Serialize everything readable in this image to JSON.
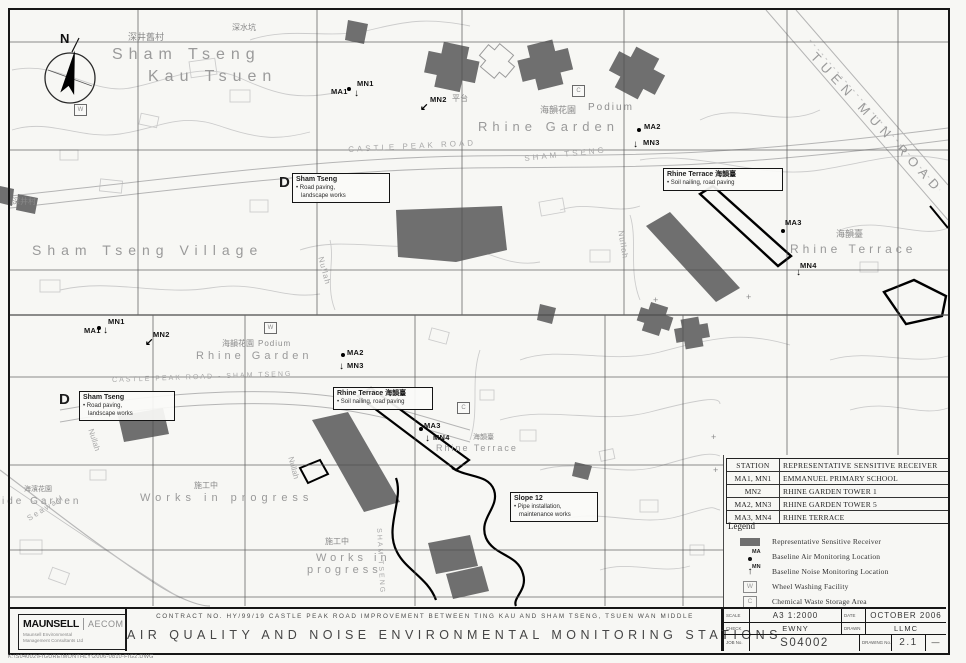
{
  "sheet": {
    "contract_line": "CONTRACT NO. HY/99/19 CASTLE PEAK ROAD IMPROVEMENT BETWEEN TING KAU AND SHAM TSENG, TSUEN WAN MIDDLE",
    "title": "AIR QUALITY AND NOISE ENVIRONMENTAL MONITORING STATIONS",
    "file_path": "K:\\S04002\\FIGURE\\MONTHLY\\2006-0810-FIG2.DWG"
  },
  "logo": {
    "name1": "MAUNSELL",
    "name2": "AECOM",
    "sub1": "Maunsell Environmental",
    "sub2": "Management Consultants Ltd"
  },
  "title_block": {
    "scale_label": "SCALE",
    "scale_value": "A3 1:2000",
    "date_label": "DATE",
    "date_value": "OCTOBER 2006",
    "check_label": "CHECK",
    "check_value": "EWNY",
    "drawn_label": "DRAWN",
    "drawn_value": "LLMC",
    "job_label": "JOB No.",
    "job_value": "S04002",
    "drawing_label": "DRAWING No.",
    "drawing_value": "2.1",
    "rev_label": "REV",
    "rev_value": "—"
  },
  "receiver_table": {
    "headers": [
      "STATION",
      "REPRESENTATIVE SENSITIVE RECEIVER"
    ],
    "rows": [
      [
        "MA1, MN1",
        "EMMANUEL PRIMARY SCHOOL"
      ],
      [
        "MN2",
        "RHINE GARDEN TOWER 1"
      ],
      [
        "MA2, MN3",
        "RHINE GARDEN TOWER 5"
      ],
      [
        "MA3, MN4",
        "RHINE TERRACE"
      ]
    ]
  },
  "legend": {
    "title": "Legend",
    "items": [
      {
        "symbol": "receiver",
        "tag": "",
        "label": "Representative Sensitive Receiver"
      },
      {
        "symbol": "air",
        "tag": "MA",
        "label": "Baseline Air Monitoring Location"
      },
      {
        "symbol": "noise",
        "tag": "MN",
        "label": "Baseline Noise Monitoring Location"
      },
      {
        "symbol": "wheel",
        "tag": "W",
        "label": "Wheel Washing Facility"
      },
      {
        "symbol": "chemical",
        "tag": "C",
        "label": "Chemical Waste Storage Area"
      }
    ]
  },
  "maps": {
    "top": {
      "labels": [
        {
          "text": "N",
          "x": 60,
          "y": 32,
          "s": 13,
          "cls": "nmark"
        },
        {
          "text": "深井舊村",
          "x": 128,
          "y": 33,
          "s": 9,
          "cls": "cn"
        },
        {
          "text": "Sham Tseng",
          "x": 112,
          "y": 47,
          "s": 16,
          "ls": 6,
          "cls": "big"
        },
        {
          "text": "Kau Tsuen",
          "x": 148,
          "y": 69,
          "s": 16,
          "ls": 6,
          "cls": "big"
        },
        {
          "text": "深水坑",
          "x": 232,
          "y": 24,
          "s": 8,
          "cls": "cn"
        },
        {
          "text": "平台",
          "x": 452,
          "y": 95,
          "s": 8,
          "cls": "cn"
        },
        {
          "text": "海韻花園",
          "x": 540,
          "y": 106,
          "s": 9,
          "cls": "cn"
        },
        {
          "text": "Podium",
          "x": 588,
          "y": 103,
          "s": 10,
          "ls": 2,
          "cls": "mid"
        },
        {
          "text": "Rhine Garden",
          "x": 478,
          "y": 120,
          "s": 13,
          "ls": 5,
          "cls": "big"
        },
        {
          "text": "CASTLE PEAK ROAD",
          "x": 348,
          "y": 146,
          "s": 8,
          "ls": 3,
          "rot": -3,
          "cls": "road"
        },
        {
          "text": "SHAM TSENG",
          "x": 524,
          "y": 155,
          "s": 8,
          "ls": 3,
          "rot": -6,
          "cls": "road"
        },
        {
          "text": "TUEN MUN ROAD",
          "x": 818,
          "y": 50,
          "s": 13,
          "ls": 6,
          "rot": 47,
          "cls": "big"
        },
        {
          "text": "Sham Tseng Village",
          "x": 32,
          "y": 243,
          "s": 14,
          "ls": 6,
          "cls": "big"
        },
        {
          "text": "深井村",
          "x": 12,
          "y": 198,
          "s": 8,
          "cls": "cn"
        },
        {
          "text": "海韻臺",
          "x": 836,
          "y": 230,
          "s": 9,
          "cls": "cn"
        },
        {
          "text": "Rhine Terrace",
          "x": 790,
          "y": 243,
          "s": 12,
          "ls": 4,
          "cls": "big"
        },
        {
          "text": "Nullah",
          "x": 324,
          "y": 256,
          "s": 8,
          "ls": 1,
          "rot": 75,
          "cls": "road"
        },
        {
          "text": "Nullah",
          "x": 624,
          "y": 230,
          "s": 8,
          "ls": 1,
          "rot": 80,
          "cls": "road"
        },
        {
          "text": "D",
          "x": 279,
          "y": 175,
          "s": 15,
          "cls": "dmark"
        },
        {
          "text": "+",
          "x": 653,
          "y": 296,
          "s": 9,
          "cls": "plusmark"
        },
        {
          "text": "+",
          "x": 746,
          "y": 293,
          "s": 9,
          "cls": "plusmark"
        }
      ],
      "stations": [
        {
          "id": "MA1",
          "x": 331,
          "y": 88,
          "marker": "dot",
          "mx": 347,
          "my": 87
        },
        {
          "id": "MN1",
          "x": 357,
          "y": 80,
          "marker": "arrow",
          "ch": "↓",
          "mx": 354,
          "my": 89
        },
        {
          "id": "MN2",
          "x": 430,
          "y": 96,
          "marker": "arrow",
          "ch": "↙",
          "mx": 420,
          "my": 103
        },
        {
          "id": "MA2",
          "x": 644,
          "y": 123,
          "marker": "dot",
          "mx": 637,
          "my": 128
        },
        {
          "id": "MN3",
          "x": 643,
          "y": 139,
          "marker": "arrow",
          "ch": "↓",
          "mx": 633,
          "my": 140
        },
        {
          "id": "MA3",
          "x": 785,
          "y": 219,
          "marker": "dot",
          "mx": 781,
          "my": 229
        },
        {
          "id": "MN4",
          "x": 800,
          "y": 262,
          "marker": "arrow",
          "ch": "↓",
          "mx": 796,
          "my": 268
        }
      ],
      "wc_marks": [
        {
          "t": "W",
          "x": 74,
          "y": 104
        },
        {
          "t": "C",
          "x": 572,
          "y": 85
        }
      ],
      "callouts": [
        {
          "x": 292,
          "y": 173,
          "w": 90,
          "title": "Sham Tseng",
          "lines": [
            "• Road paving,",
            "   landscape works"
          ]
        },
        {
          "x": 663,
          "y": 168,
          "w": 112,
          "title": "Rhine Terrace 海韻臺",
          "lines": [
            "• Soil nailing, road paving"
          ]
        }
      ]
    },
    "bottom": {
      "labels": [
        {
          "text": "Rhine Garden",
          "x": 196,
          "y": 351,
          "s": 11,
          "ls": 4,
          "cls": "big"
        },
        {
          "text": "海韻花園",
          "x": 222,
          "y": 340,
          "s": 8,
          "cls": "cn"
        },
        {
          "text": "Podium",
          "x": 258,
          "y": 340,
          "s": 8,
          "ls": 1,
          "cls": "mid"
        },
        {
          "text": "CASTLE PEAK ROAD - SHAM TSENG",
          "x": 112,
          "y": 377,
          "s": 7,
          "ls": 2,
          "rot": -2,
          "cls": "road"
        },
        {
          "text": "D",
          "x": 59,
          "y": 392,
          "s": 15,
          "cls": "dmark"
        },
        {
          "text": "Rhine Terrace",
          "x": 436,
          "y": 444,
          "s": 9,
          "ls": 2,
          "cls": "big"
        },
        {
          "text": "海韻臺",
          "x": 473,
          "y": 434,
          "s": 7,
          "cls": "cn"
        },
        {
          "text": "施工中",
          "x": 194,
          "y": 482,
          "s": 8,
          "cls": "cn"
        },
        {
          "text": "Works in progress",
          "x": 140,
          "y": 493,
          "s": 11,
          "ls": 5,
          "cls": "big"
        },
        {
          "text": "施工中",
          "x": 325,
          "y": 538,
          "s": 8,
          "cls": "cn"
        },
        {
          "text": "Works in",
          "x": 316,
          "y": 553,
          "s": 11,
          "ls": 4,
          "cls": "big"
        },
        {
          "text": "progress",
          "x": 307,
          "y": 565,
          "s": 11,
          "ls": 4,
          "cls": "big"
        },
        {
          "text": "ide Garden",
          "x": 2,
          "y": 497,
          "s": 10,
          "ls": 3,
          "cls": "big"
        },
        {
          "text": "海濱花園",
          "x": 24,
          "y": 486,
          "s": 7,
          "cls": "cn"
        },
        {
          "text": "Seawall",
          "x": 26,
          "y": 516,
          "s": 8,
          "ls": 2,
          "rot": -32,
          "cls": "road"
        },
        {
          "text": "Nullah",
          "x": 94,
          "y": 428,
          "s": 8,
          "rot": 72,
          "cls": "road"
        },
        {
          "text": "Nullah",
          "x": 294,
          "y": 456,
          "s": 8,
          "rot": 75,
          "cls": "road"
        },
        {
          "text": "SHAM TSENG",
          "x": 382,
          "y": 528,
          "s": 7,
          "ls": 2,
          "rot": 87,
          "cls": "road"
        },
        {
          "text": "+",
          "x": 711,
          "y": 433,
          "s": 9,
          "cls": "plusmark"
        },
        {
          "text": "+",
          "x": 713,
          "y": 466,
          "s": 9,
          "cls": "plusmark"
        }
      ],
      "stations": [
        {
          "id": "MA1",
          "x": 84,
          "y": 327,
          "marker": "dot",
          "mx": 97,
          "my": 326
        },
        {
          "id": "MN1",
          "x": 108,
          "y": 318,
          "marker": "arrow",
          "ch": "↓",
          "mx": 103,
          "my": 326
        },
        {
          "id": "MN2",
          "x": 153,
          "y": 331,
          "marker": "arrow",
          "ch": "↙",
          "mx": 145,
          "my": 338
        },
        {
          "id": "MA2",
          "x": 347,
          "y": 349,
          "marker": "dot",
          "mx": 341,
          "my": 353
        },
        {
          "id": "MN3",
          "x": 347,
          "y": 362,
          "marker": "arrow",
          "ch": "↓",
          "mx": 339,
          "my": 362
        },
        {
          "id": "MA3",
          "x": 424,
          "y": 422,
          "marker": "dot",
          "mx": 419,
          "my": 427
        },
        {
          "id": "MN4",
          "x": 433,
          "y": 434,
          "marker": "arrow",
          "ch": "↓",
          "mx": 425,
          "my": 434
        }
      ],
      "wc_marks": [
        {
          "t": "W",
          "x": 264,
          "y": 322
        },
        {
          "t": "C",
          "x": 457,
          "y": 402
        }
      ],
      "callouts": [
        {
          "x": 79,
          "y": 391,
          "w": 88,
          "title": "Sham Tseng",
          "lines": [
            "• Road paving,",
            "   landscape works"
          ]
        },
        {
          "x": 333,
          "y": 387,
          "w": 92,
          "title": "Rhine Terrace 海韻臺",
          "lines": [
            "• Soil nailing, road paving"
          ]
        },
        {
          "x": 510,
          "y": 492,
          "w": 80,
          "title": "Slope 12",
          "lines": [
            "• Pipe installation,",
            "   maintenance works"
          ]
        }
      ]
    }
  },
  "colors": {
    "paper": "#f7f7f4",
    "ink": "#161616",
    "building_fill": "#6f6f6f",
    "contour": "#cccccc",
    "grid": "#4f4f4f",
    "map_text": "#9a9a9a"
  }
}
